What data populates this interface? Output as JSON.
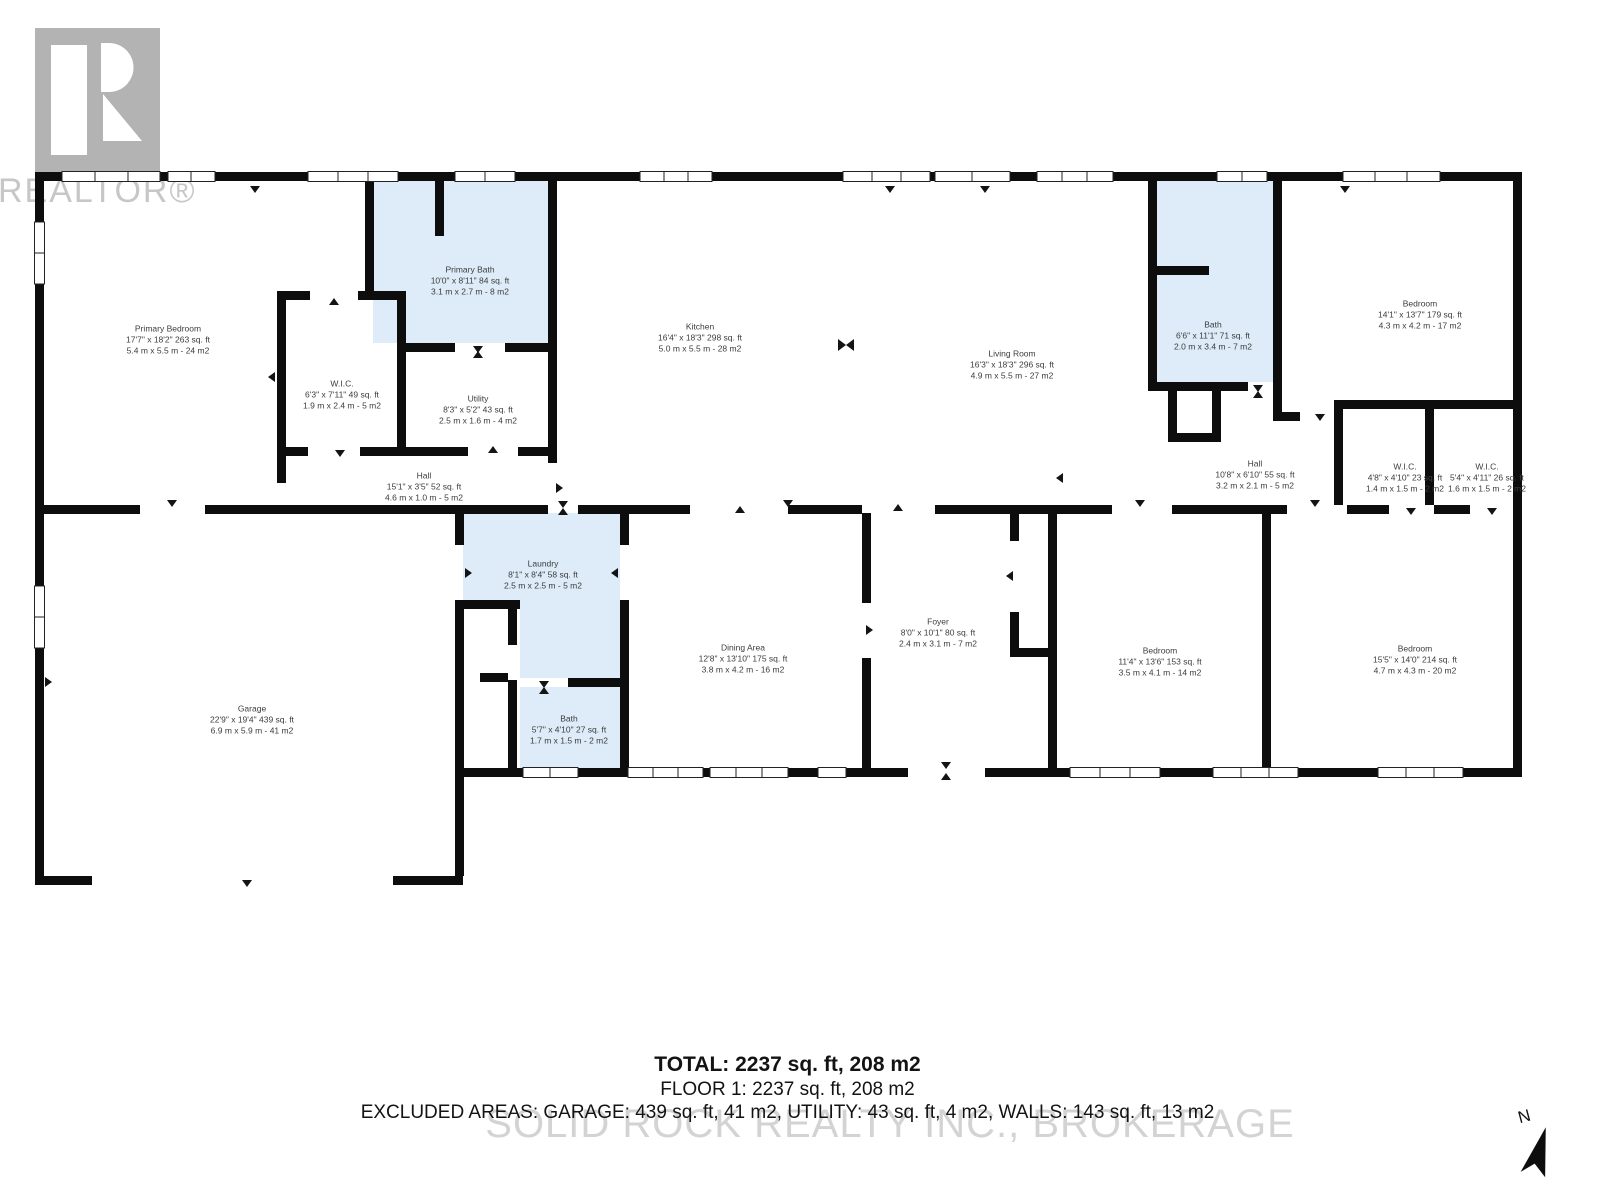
{
  "branding": {
    "realtor_text": "REALTOR®"
  },
  "watermark_text": "SOLID ROCK REALTY INC., BROKERAGE",
  "compass_label": "N",
  "colors": {
    "highlight": "#ddecf8",
    "wall": "#0d0d0d",
    "label": "#3c3c3c",
    "summary": "#131313",
    "watermark": "#c9c9c9",
    "logobg": "#b3b3b3",
    "logotext": "#c7c7c7"
  },
  "summary": {
    "total": "TOTAL: 2237 sq. ft, 208 m2",
    "floor": "FLOOR 1: 2237 sq. ft, 208 m2",
    "excluded": "EXCLUDED AREAS: GARAGE: 439 sq. ft, 41 m2, UTILITY: 43 sq. ft, 4 m2, WALLS: 143 sq. ft, 13 m2"
  },
  "rooms": [
    {
      "id": "primary-bedroom",
      "name": "Primary Bedroom",
      "imperial": "17'7\" x 18'2\" 263 sq. ft",
      "metric": "5.4 m x 5.5 m - 24 m2",
      "cx": 168,
      "cy": 340,
      "highlighted": false
    },
    {
      "id": "primary-wic",
      "name": "W.I.C.",
      "imperial": "6'3\" x 7'11\" 49 sq. ft",
      "metric": "1.9 m x 2.4 m - 5 m2",
      "cx": 342,
      "cy": 395,
      "highlighted": false
    },
    {
      "id": "primary-bath",
      "name": "Primary Bath",
      "imperial": "10'0\" x 8'11\" 84 sq. ft",
      "metric": "3.1 m x 2.7 m - 8 m2",
      "cx": 470,
      "cy": 281,
      "highlighted": true
    },
    {
      "id": "utility",
      "name": "Utility",
      "imperial": "8'3\" x 5'2\" 43 sq. ft",
      "metric": "2.5 m x 1.6 m - 4 m2",
      "cx": 478,
      "cy": 410,
      "highlighted": false
    },
    {
      "id": "kitchen",
      "name": "Kitchen",
      "imperial": "16'4\" x 18'3\" 298 sq. ft",
      "metric": "5.0 m x 5.5 m - 28 m2",
      "cx": 700,
      "cy": 338,
      "highlighted": false
    },
    {
      "id": "hall-left",
      "name": "Hall",
      "imperial": "15'1\" x 3'5\" 52 sq. ft",
      "metric": "4.6 m x 1.0 m - 5 m2",
      "cx": 424,
      "cy": 487,
      "highlighted": false
    },
    {
      "id": "living-room",
      "name": "Living Room",
      "imperial": "16'3\" x 18'3\" 296 sq. ft",
      "metric": "4.9 m x 5.5 m - 27 m2",
      "cx": 1012,
      "cy": 365,
      "highlighted": false
    },
    {
      "id": "bath-main",
      "name": "Bath",
      "imperial": "6'6\" x 11'1\" 71 sq. ft",
      "metric": "2.0 m x 3.4 m - 7 m2",
      "cx": 1213,
      "cy": 336,
      "highlighted": true
    },
    {
      "id": "bedroom-ne",
      "name": "Bedroom",
      "imperial": "14'1\" x 13'7\" 179 sq. ft",
      "metric": "4.3 m x 4.2 m - 17 m2",
      "cx": 1420,
      "cy": 315,
      "highlighted": false
    },
    {
      "id": "hall-right",
      "name": "Hall",
      "imperial": "10'8\" x 6'10\" 55 sq. ft",
      "metric": "3.2 m x 2.1 m - 5 m2",
      "cx": 1255,
      "cy": 475,
      "highlighted": false
    },
    {
      "id": "wic-1",
      "name": "W.I.C.",
      "imperial": "4'8\" x 4'10\" 23 sq. ft",
      "metric": "1.4 m x 1.5 m - 2 m2",
      "cx": 1405,
      "cy": 478,
      "highlighted": false
    },
    {
      "id": "wic-2",
      "name": "W.I.C.",
      "imperial": "5'4\" x 4'11\" 26 sq. ft",
      "metric": "1.6 m x 1.5 m - 2 m2",
      "cx": 1487,
      "cy": 478,
      "highlighted": false
    },
    {
      "id": "laundry",
      "name": "Laundry",
      "imperial": "8'1\" x 8'4\" 58 sq. ft",
      "metric": "2.5 m x 2.5 m - 5 m2",
      "cx": 543,
      "cy": 575,
      "highlighted": true
    },
    {
      "id": "dining-area",
      "name": "Dining Area",
      "imperial": "12'8\" x 13'10\" 175 sq. ft",
      "metric": "3.8 m x 4.2 m - 16 m2",
      "cx": 743,
      "cy": 659,
      "highlighted": false
    },
    {
      "id": "bath-2",
      "name": "Bath",
      "imperial": "5'7\" x 4'10\" 27 sq. ft",
      "metric": "1.7 m x 1.5 m - 2 m2",
      "cx": 569,
      "cy": 730,
      "highlighted": true
    },
    {
      "id": "foyer",
      "name": "Foyer",
      "imperial": "8'0\" x 10'1\" 80 sq. ft",
      "metric": "2.4 m x 3.1 m - 7 m2",
      "cx": 938,
      "cy": 633,
      "highlighted": false
    },
    {
      "id": "bedroom-s1",
      "name": "Bedroom",
      "imperial": "11'4\" x 13'6\" 153 sq. ft",
      "metric": "3.5 m x 4.1 m - 14 m2",
      "cx": 1160,
      "cy": 662,
      "highlighted": false
    },
    {
      "id": "bedroom-s2",
      "name": "Bedroom",
      "imperial": "15'5\" x 14'0\" 214 sq. ft",
      "metric": "4.7 m x 4.3 m - 20 m2",
      "cx": 1415,
      "cy": 660,
      "highlighted": false
    },
    {
      "id": "garage",
      "name": "Garage",
      "imperial": "22'9\" x 19'4\" 439 sq. ft",
      "metric": "6.9 m x 5.9 m - 41 m2",
      "cx": 252,
      "cy": 720,
      "highlighted": false
    }
  ]
}
